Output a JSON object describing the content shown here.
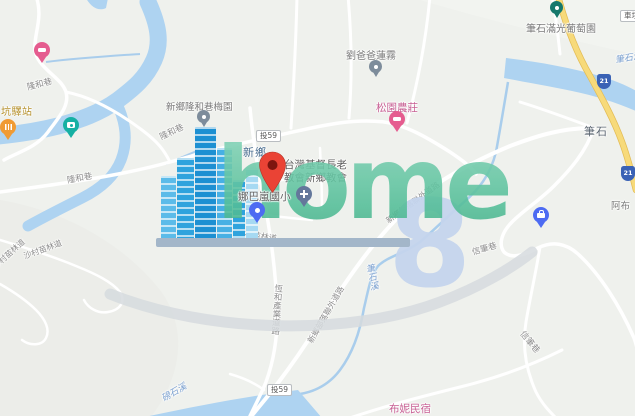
{
  "map": {
    "town_labels": {
      "xinxiang": "新鄉",
      "bishi": "筆石"
    },
    "place_labels": {
      "station": "坑驛站",
      "meiyuan": "新鄉隆和巷梅園",
      "liu_baba": "劉爸爸蓮霧",
      "songyuan_farm": "松園農莊",
      "bishi_vineyard": "筆石滿光葡萄園",
      "church_line1": "台灣基督長老",
      "church_line2": "教會新鄉教會",
      "school": "娜巴嵐國小",
      "bnb": "布妮民宿",
      "abu": "阿布"
    },
    "road_labels": {
      "longhe_lane": "隆和巷",
      "shacun_road": "沙村苗林道",
      "hengh_industrial": "恆和產業道路",
      "tribe_outer_road": "新鄉部落聯外道路",
      "xinbi_lane": "信筆巷"
    },
    "water_labels": {
      "bishi_creek": "筆石溪",
      "pangshi_creek": "磅石溪"
    },
    "badges": {
      "county_route": "投59",
      "provincial_highway": "21",
      "edge_badge": "車埕"
    },
    "watermark": {
      "word": "home",
      "numeral": "8"
    },
    "icons": {
      "lodging_pin": "bed-icon",
      "restaurant_pin": "fork-knife-icon",
      "photo_pin": "camera-icon",
      "church_pin": "cross-icon",
      "work_pin": "briefcase-icon",
      "generic_pin": "dot-icon",
      "destination_pin": "red-marker-icon"
    },
    "colors": {
      "land": "#eff1ed",
      "water": "#aed3f1",
      "highway_yellow": "#f7da7a",
      "destination_red": "#EA4335",
      "lodging_pink": "#e55c8f",
      "restaurant_orange": "#f09b34",
      "photo_teal": "#16b0a3",
      "dark_teal_pin": "#16786c",
      "blue_pin": "#4d6bf2",
      "church_slate": "#64779b",
      "gray_pin": "#7d8c9b",
      "watermark_teal": "#55bf99",
      "watermark_blue_8": "#c5d5ee",
      "shield_blue": "#3a62b5"
    }
  }
}
